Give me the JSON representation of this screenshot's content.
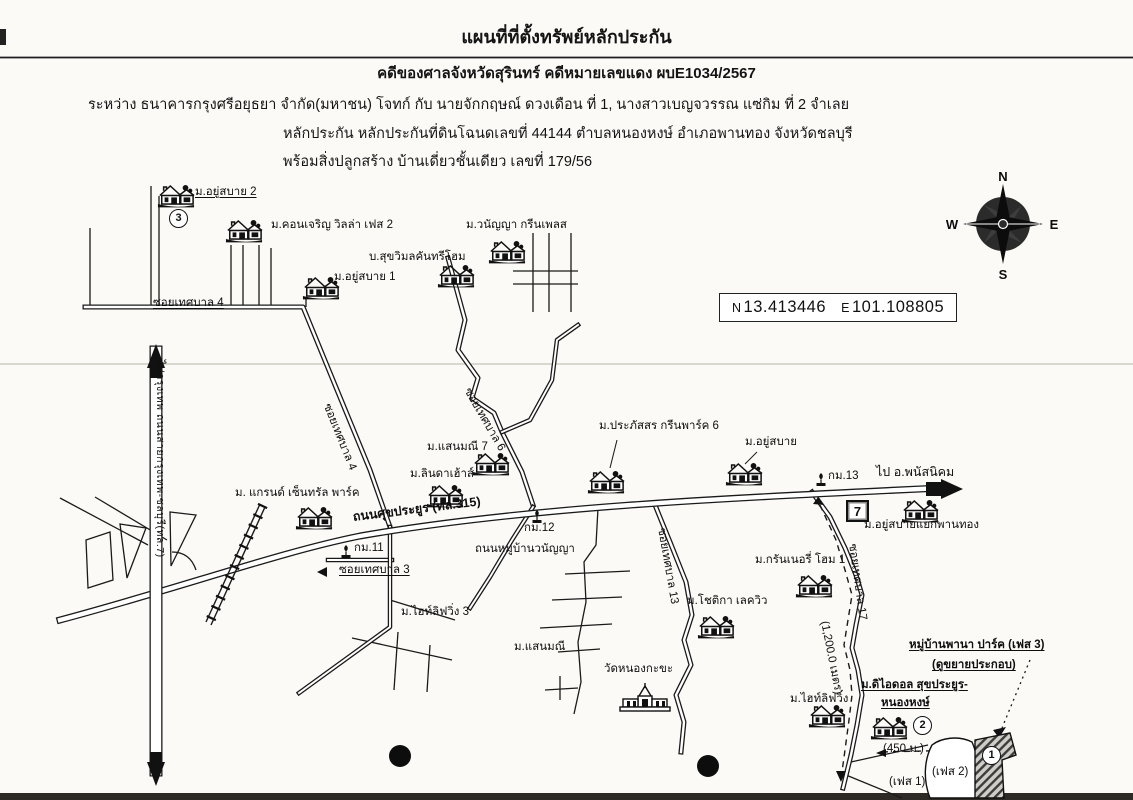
{
  "header": {
    "title": "แผนที่ที่ตั้งทรัพย์หลักประกัน",
    "case_line": "คดีของศาลจังหวัดสุรินทร์ คดีหมายเลขแดง ผบE1034/2567",
    "parties_line": "ระหว่าง ธนาคารกรุงศรีอยุธยา จำกัด(มหาชน) โจทก์ กับ นายจักกฤษณ์ ดวงเดือน ที่ 1, นางสาวเบญจวรรณ แซ่กิม ที่ 2 จำเลย",
    "collateral_line": "หลักประกัน หลักประกันที่ดินโฉนดเลขที่ 44144 ตำบลหนองหงษ์ อำเภอพานทอง จังหวัดชลบุรี",
    "building_line": "พร้อมสิ่งปลูกสร้าง บ้านเดี่ยวชั้นเดียว เลขที่ 179/56"
  },
  "coords_box": {
    "n_label": "N",
    "latitude": "13.413446",
    "e_label": "E",
    "longitude": "101.108805"
  },
  "compass": {
    "north": "N",
    "east": "E",
    "south": "S",
    "west": "W"
  },
  "map": {
    "villages": {
      "yusabai2": "ม.อยู่สบาย 2",
      "khonjaroen": "ม.คอนเจริญ วิลล่า เฟส 2",
      "wananya_greenplace": "ม.วนัญญา กรีนเพลส",
      "sukwimol": "บ.สุขวิมลคันทรีโฮม",
      "yusabai1": "ม.อยู่สบาย 1",
      "saenmanee7": "ม.แสนมณี 7",
      "linda_house": "ม.ลินดาเฮ้าส์",
      "grand_central_park": "ม. แกรนด์ เซ็นทรัล พาร์ค",
      "prapassorn": "ม.ประภัสสร กรีนพาร์ค 6",
      "yusabai": "ม.อยู่สบาย",
      "yusabai_phanthong": "ม.อยู่สบายแยกพานทอง",
      "grannery_home1": "ม.กรันเนอรี่ โฮม 1",
      "chotika_lakeview": "ม.โชติกา เลควิว",
      "hilife3": "ม.ไฮท์ลิฟวิ่ง 3",
      "saenmanee": "ม.แสนมณี",
      "hilife": "ม.ไฮท์ลิฟวิ่ง",
      "the_idol_line1": "ม.ดิไอดอล สุขประยูร-",
      "the_idol_line2": "หนองหงษ์",
      "wat_nongkakha": "วัดหนองกะขะ"
    },
    "roads": {
      "soi_thetsaban4": "ซอยเทศบาล 4",
      "soi_thetsaban4_diag": "ซอยเทศบาล 4",
      "soi_thetsaban6": "ซอยเทศบาล 6",
      "soi_thetsaban3": "ซอยเทศบาล 3",
      "soi_thetsaban13": "ซอยเทศบาล 13",
      "soi_thetsaban17": "ซอยเทศบาล 17",
      "sukprayoon_315": "ถนนศุขประยูร (ทล.315)",
      "wananya_road": "ถนนหมู่บ้านวนัญญา",
      "bangkok_chonburi_7": "ไปกรุงเทพ  ถนนสายกรุงเทพ-ชลบุรี(ทล.7)",
      "to_phanatnikhom": "ไป อ.พนัสนิคม"
    },
    "milestones": {
      "km11": "กม.11",
      "km12": "กม.12",
      "km13": "กม.13"
    },
    "seven_eleven": "7",
    "notes": {
      "pana_park": "หมู่บ้านพานา ปาร์ค (เฟส 3)",
      "see_enlargement": "(ดูขยายประกอบ)",
      "dist450": "(450 ม.)",
      "dist1200": "(1,200.0 เมตร)",
      "phase1": "(เฟส 1)",
      "phase2": "(เฟส 2)"
    },
    "circles": {
      "c1": "1",
      "c2": "2",
      "c3": "3"
    }
  }
}
